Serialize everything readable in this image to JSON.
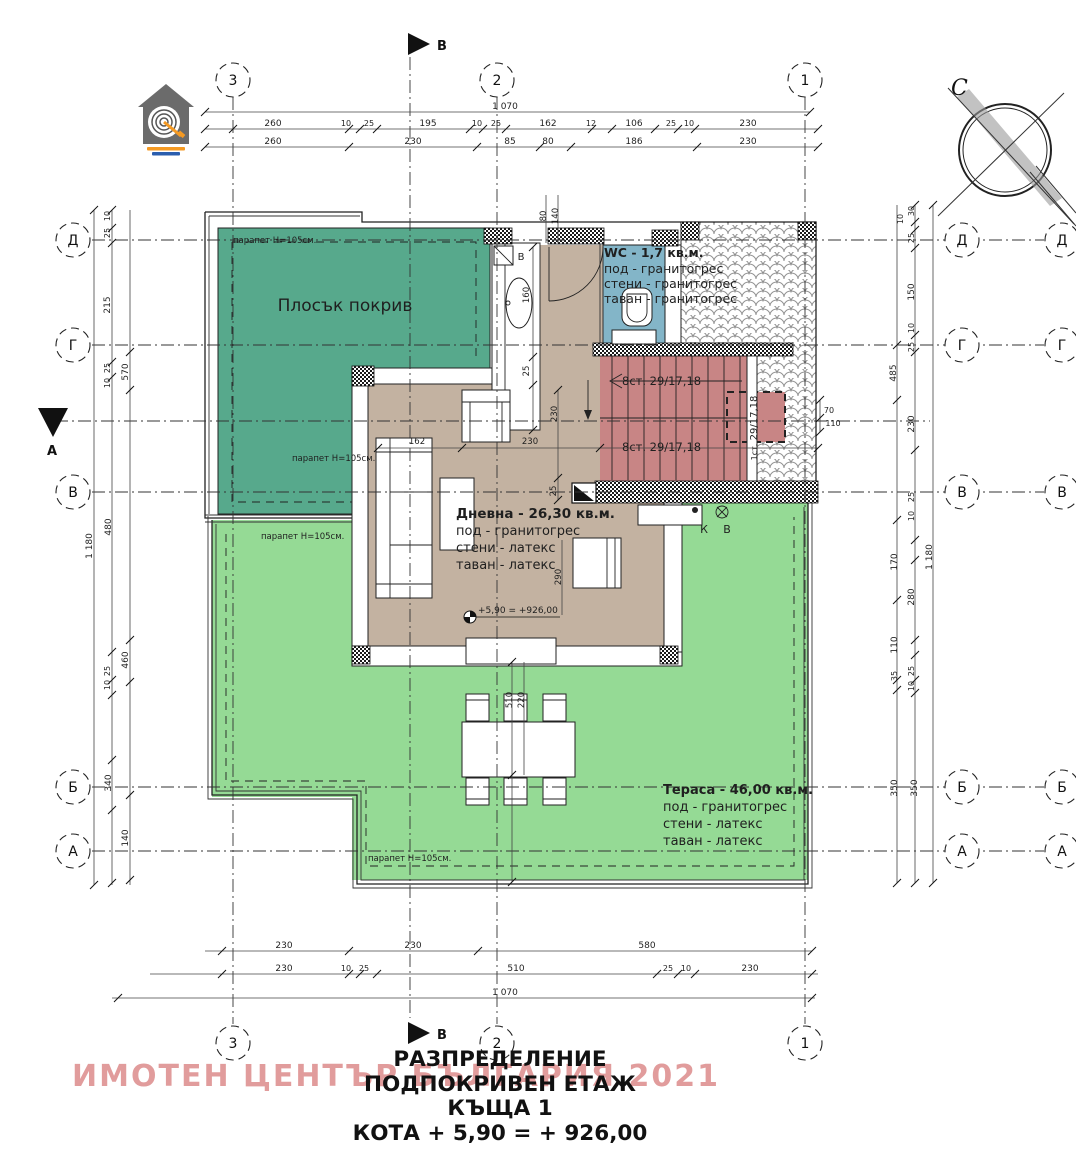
{
  "colors": {
    "line": "#1f1f1f",
    "flat_roof": "#57a98c",
    "terrace": "#95da95",
    "living": "#c3b2a1",
    "wc": "#83b5c8",
    "stairs": "#c88585",
    "watermark": "rgba(206,96,96,0.62)"
  },
  "title_block": {
    "line1": "РАЗПРЕДЕЛЕНИЕ",
    "line2": "ПОДПОКРИВЕН ЕТАЖ",
    "line3": "КЪЩА 1",
    "line4": "КОТА + 5,90 = + 926,00"
  },
  "watermark": {
    "text": "ИМОТЕН ЦЕНТЪР БЪЛГАРИЯ 2021"
  },
  "compass": {
    "label": "С"
  },
  "section_markers": {
    "top": {
      "label": "В"
    },
    "bottom": {
      "label": "В"
    },
    "left": {
      "label": "А"
    }
  },
  "axis_bubbles": [
    {
      "l": "3",
      "x": 233,
      "y": 80
    },
    {
      "l": "2",
      "x": 497,
      "y": 80
    },
    {
      "l": "1",
      "x": 805,
      "y": 80
    },
    {
      "l": "3",
      "x": 233,
      "y": 1043
    },
    {
      "l": "2",
      "x": 497,
      "y": 1043
    },
    {
      "l": "1",
      "x": 805,
      "y": 1043
    },
    {
      "l": "Д",
      "x": 73,
      "y": 240
    },
    {
      "l": "Г",
      "x": 73,
      "y": 345
    },
    {
      "l": "В",
      "x": 73,
      "y": 492
    },
    {
      "l": "Б",
      "x": 73,
      "y": 787
    },
    {
      "l": "А",
      "x": 73,
      "y": 851
    },
    {
      "l": "Д",
      "x": 962,
      "y": 240
    },
    {
      "l": "Г",
      "x": 962,
      "y": 345
    },
    {
      "l": "В",
      "x": 962,
      "y": 492
    },
    {
      "l": "Б",
      "x": 962,
      "y": 787
    },
    {
      "l": "А",
      "x": 962,
      "y": 851
    },
    {
      "l": "Д",
      "x": 1062,
      "y": 240
    },
    {
      "l": "Г",
      "x": 1062,
      "y": 345
    },
    {
      "l": "В",
      "x": 1062,
      "y": 492
    },
    {
      "l": "Б",
      "x": 1062,
      "y": 787
    },
    {
      "l": "А",
      "x": 1062,
      "y": 851
    }
  ],
  "dimensions": {
    "top": [
      {
        "t": "1 070",
        "x": 505,
        "y": 109
      },
      {
        "t": "260",
        "x": 273,
        "y": 126
      },
      {
        "t": "10",
        "x": 346,
        "y": 126,
        "s": 8
      },
      {
        "t": "25",
        "x": 369,
        "y": 126,
        "s": 8
      },
      {
        "t": "195",
        "x": 428,
        "y": 126
      },
      {
        "t": "10",
        "x": 477,
        "y": 126,
        "s": 8
      },
      {
        "t": "25",
        "x": 496,
        "y": 126,
        "s": 8
      },
      {
        "t": "162",
        "x": 548,
        "y": 126
      },
      {
        "t": "12",
        "x": 591,
        "y": 126,
        "s": 8
      },
      {
        "t": "106",
        "x": 634,
        "y": 126
      },
      {
        "t": "25",
        "x": 671,
        "y": 126,
        "s": 8
      },
      {
        "t": "10",
        "x": 689,
        "y": 126,
        "s": 8
      },
      {
        "t": "230",
        "x": 748,
        "y": 126
      },
      {
        "t": "260",
        "x": 273,
        "y": 144
      },
      {
        "t": "230",
        "x": 413,
        "y": 144
      },
      {
        "t": "85",
        "x": 510,
        "y": 144
      },
      {
        "t": "80",
        "x": 548,
        "y": 144
      },
      {
        "t": "186",
        "x": 634,
        "y": 144
      },
      {
        "t": "230",
        "x": 748,
        "y": 144
      }
    ],
    "bottom": [
      {
        "t": "230",
        "x": 284,
        "y": 948
      },
      {
        "t": "230",
        "x": 413,
        "y": 948
      },
      {
        "t": "580",
        "x": 647,
        "y": 948
      },
      {
        "t": "230",
        "x": 284,
        "y": 971
      },
      {
        "t": "10",
        "x": 346,
        "y": 971,
        "s": 8
      },
      {
        "t": "25",
        "x": 364,
        "y": 971,
        "s": 8
      },
      {
        "t": "510",
        "x": 516,
        "y": 971
      },
      {
        "t": "25",
        "x": 668,
        "y": 971,
        "s": 8
      },
      {
        "t": "10",
        "x": 686,
        "y": 971,
        "s": 8
      },
      {
        "t": "230",
        "x": 750,
        "y": 971
      },
      {
        "t": "1 070",
        "x": 505,
        "y": 995
      }
    ],
    "left": [
      {
        "t": "10",
        "x": 110,
        "y": 216,
        "r": -90,
        "s": 8
      },
      {
        "t": "25",
        "x": 110,
        "y": 233,
        "r": -90,
        "s": 8
      },
      {
        "t": "215",
        "x": 110,
        "y": 305,
        "r": -90
      },
      {
        "t": "25",
        "x": 110,
        "y": 368,
        "r": -90,
        "s": 8
      },
      {
        "t": "10",
        "x": 110,
        "y": 383,
        "r": -90,
        "s": 8
      },
      {
        "t": "570",
        "x": 128,
        "y": 372,
        "r": -90
      },
      {
        "t": "480",
        "x": 111,
        "y": 527,
        "r": -90
      },
      {
        "t": "1 180",
        "x": 92,
        "y": 546,
        "r": -90
      },
      {
        "t": "460",
        "x": 128,
        "y": 660,
        "r": -90
      },
      {
        "t": "25",
        "x": 110,
        "y": 671,
        "r": -90,
        "s": 8
      },
      {
        "t": "10",
        "x": 110,
        "y": 685,
        "r": -90,
        "s": 8
      },
      {
        "t": "340",
        "x": 111,
        "y": 783,
        "r": -90
      },
      {
        "t": "140",
        "x": 128,
        "y": 838,
        "r": -90
      }
    ],
    "right": [
      {
        "t": "30",
        "x": 914,
        "y": 211,
        "r": -90,
        "s": 8
      },
      {
        "t": "10",
        "x": 903,
        "y": 219,
        "r": -90,
        "s": 8
      },
      {
        "t": "25",
        "x": 914,
        "y": 238,
        "r": -90,
        "s": 8
      },
      {
        "t": "150",
        "x": 914,
        "y": 292,
        "r": -90
      },
      {
        "t": "10",
        "x": 914,
        "y": 328,
        "r": -90,
        "s": 8
      },
      {
        "t": "25",
        "x": 914,
        "y": 347,
        "r": -90,
        "s": 8
      },
      {
        "t": "485",
        "x": 896,
        "y": 373,
        "r": -90
      },
      {
        "t": "230",
        "x": 914,
        "y": 424,
        "r": -90
      },
      {
        "t": "25",
        "x": 914,
        "y": 497,
        "r": -90,
        "s": 8
      },
      {
        "t": "10",
        "x": 914,
        "y": 516,
        "r": -90,
        "s": 8
      },
      {
        "t": "170",
        "x": 897,
        "y": 562,
        "r": -90
      },
      {
        "t": "1 180",
        "x": 932,
        "y": 557,
        "r": -90
      },
      {
        "t": "280",
        "x": 914,
        "y": 597,
        "r": -90
      },
      {
        "t": "110",
        "x": 897,
        "y": 645,
        "r": -90
      },
      {
        "t": "35",
        "x": 897,
        "y": 676,
        "r": -90,
        "s": 8
      },
      {
        "t": "25",
        "x": 914,
        "y": 671,
        "r": -90,
        "s": 8
      },
      {
        "t": "10",
        "x": 914,
        "y": 686,
        "r": -90,
        "s": 8
      },
      {
        "t": "350",
        "x": 897,
        "y": 788,
        "r": -90
      },
      {
        "t": "350",
        "x": 917,
        "y": 788,
        "r": -90
      }
    ],
    "interior": [
      {
        "t": "160",
        "x": 529,
        "y": 295,
        "r": -90,
        "s": 8.5
      },
      {
        "t": "25",
        "x": 529,
        "y": 371,
        "r": -90,
        "s": 8.5
      },
      {
        "t": "80",
        "x": 546,
        "y": 216,
        "r": -90,
        "s": 8.5
      },
      {
        "t": "140",
        "x": 558,
        "y": 216,
        "r": -90,
        "s": 8.5
      },
      {
        "t": "230",
        "x": 557,
        "y": 414,
        "r": -90,
        "s": 8.5
      },
      {
        "t": "25",
        "x": 556,
        "y": 491,
        "r": -90,
        "s": 8.5
      },
      {
        "t": "290",
        "x": 561,
        "y": 577,
        "r": -90,
        "s": 8.5
      },
      {
        "t": "510",
        "x": 512,
        "y": 700,
        "r": -90,
        "s": 8.5
      },
      {
        "t": "220",
        "x": 524,
        "y": 700,
        "r": -90,
        "s": 8.5
      },
      {
        "t": "162",
        "x": 417,
        "y": 444,
        "s": 8.5
      },
      {
        "t": "230",
        "x": 530,
        "y": 444,
        "s": 8.5
      },
      {
        "t": "70",
        "x": 829,
        "y": 413,
        "s": 8
      },
      {
        "t": "110",
        "x": 833,
        "y": 426,
        "s": 8
      },
      {
        "t": "29/17,18",
        "x": 757,
        "y": 418,
        "r": -90,
        "s": 10
      },
      {
        "t": "1ст.",
        "x": 757,
        "y": 452,
        "r": -90,
        "s": 8
      }
    ]
  },
  "room_labels": [
    {
      "t": "WC - 1,7 кв.м.",
      "x": 604,
      "y": 257,
      "s": 12.5,
      "w": "bold",
      "a": "start",
      "n": "wc-label-title"
    },
    {
      "t": "под - гранитогрес",
      "x": 604,
      "y": 273,
      "s": 12.5,
      "a": "start",
      "n": "wc-label-floor"
    },
    {
      "t": "стени - гранитогрес",
      "x": 604,
      "y": 288,
      "s": 12.5,
      "a": "start",
      "n": "wc-label-walls"
    },
    {
      "t": "таван - гранитогрес",
      "x": 604,
      "y": 303,
      "s": 12.5,
      "a": "start",
      "n": "wc-label-ceiling"
    },
    {
      "t": "Дневна - 26,30 кв.м.",
      "x": 456,
      "y": 518,
      "s": 13.5,
      "w": "bold",
      "a": "start",
      "n": "living-label-title"
    },
    {
      "t": "под - гранитогрес",
      "x": 456,
      "y": 535,
      "s": 13,
      "a": "start",
      "n": "living-label-floor"
    },
    {
      "t": "стени - латекс",
      "x": 456,
      "y": 552,
      "s": 13,
      "a": "start",
      "n": "living-label-walls"
    },
    {
      "t": "таван - латекс",
      "x": 456,
      "y": 569,
      "s": 13,
      "a": "start",
      "n": "living-label-ceiling"
    },
    {
      "t": "Тераса - 46,00 кв.м.",
      "x": 663,
      "y": 794,
      "s": 13,
      "w": "bold",
      "a": "start",
      "n": "terrace-label-title"
    },
    {
      "t": "под - гранитогрес",
      "x": 663,
      "y": 811,
      "s": 13,
      "a": "start",
      "n": "terrace-label-floor"
    },
    {
      "t": "стени - латекс",
      "x": 663,
      "y": 828,
      "s": 13,
      "a": "start",
      "n": "terrace-label-walls"
    },
    {
      "t": "таван - латекс",
      "x": 663,
      "y": 845,
      "s": 13,
      "a": "start",
      "n": "terrace-label-ceiling"
    },
    {
      "t": "Плосък покрив",
      "x": 345,
      "y": 311,
      "s": 17,
      "n": "flat-roof-label"
    },
    {
      "t": "8ст. 29/17,18",
      "x": 622,
      "y": 385,
      "s": 11.5,
      "a": "start",
      "n": "stairs-flight-label"
    },
    {
      "t": "8ст. 29/17,18",
      "x": 622,
      "y": 451,
      "s": 11.5,
      "a": "start",
      "n": "stairs-flight-label"
    }
  ],
  "misc_labels": [
    {
      "t": "парапет Н=105см.",
      "x": 233,
      "y": 243,
      "s": 8.5,
      "a": "start",
      "n": "parapet-label"
    },
    {
      "t": "парапет Н=105см.",
      "x": 292,
      "y": 461,
      "s": 8.5,
      "a": "start",
      "n": "parapet-label"
    },
    {
      "t": "парапет Н=105см.",
      "x": 261,
      "y": 539,
      "s": 8.5,
      "a": "start",
      "n": "parapet-label"
    },
    {
      "t": "парапет Н=105см.",
      "x": 368,
      "y": 861,
      "s": 8.5,
      "a": "start",
      "n": "parapet-label"
    },
    {
      "t": "К",
      "x": 704,
      "y": 533,
      "s": 11,
      "n": "duct-label-k"
    },
    {
      "t": "В",
      "x": 727,
      "y": 533,
      "s": 11,
      "n": "duct-label-v"
    },
    {
      "t": "В",
      "x": 521,
      "y": 260,
      "s": 10,
      "n": "boiler-label"
    },
    {
      "t": "+5,90 = +926,00",
      "x": 478,
      "y": 613,
      "s": 9,
      "a": "start",
      "n": "level-mark-label"
    }
  ]
}
